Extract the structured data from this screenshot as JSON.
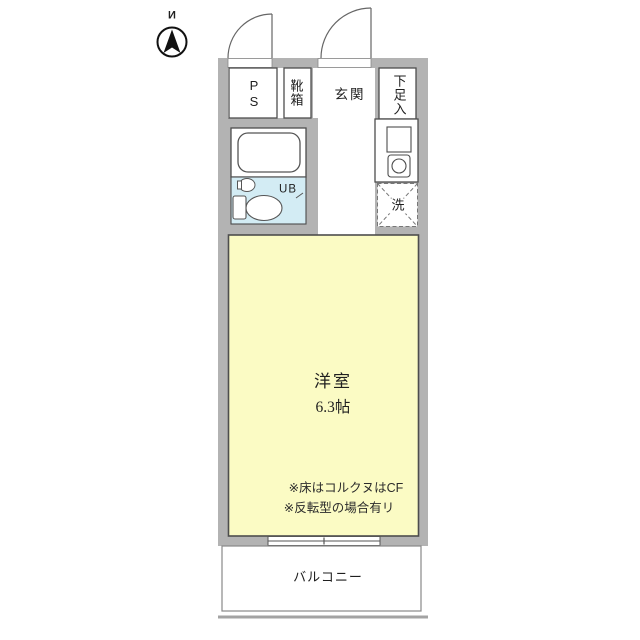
{
  "compass": {
    "label": "И"
  },
  "plan": {
    "ps": "PS",
    "shoe_box": "靴箱",
    "entrance": "玄関",
    "shoe_storage": "下足入",
    "unit_bath": "UB",
    "laundry": "洗",
    "room": {
      "name": "洋室",
      "size": "6.3帖",
      "notes": [
        "※床はコルクヌはCF",
        "※反転型の場合有リ"
      ]
    },
    "balcony": "バルコニー"
  },
  "colors": {
    "wall": "#b3b3b3",
    "room_fill": "#fbfbc4",
    "bath_fill": "#d3ecf4",
    "outline": "#4d4d4d",
    "dashed_line": "#777777"
  }
}
